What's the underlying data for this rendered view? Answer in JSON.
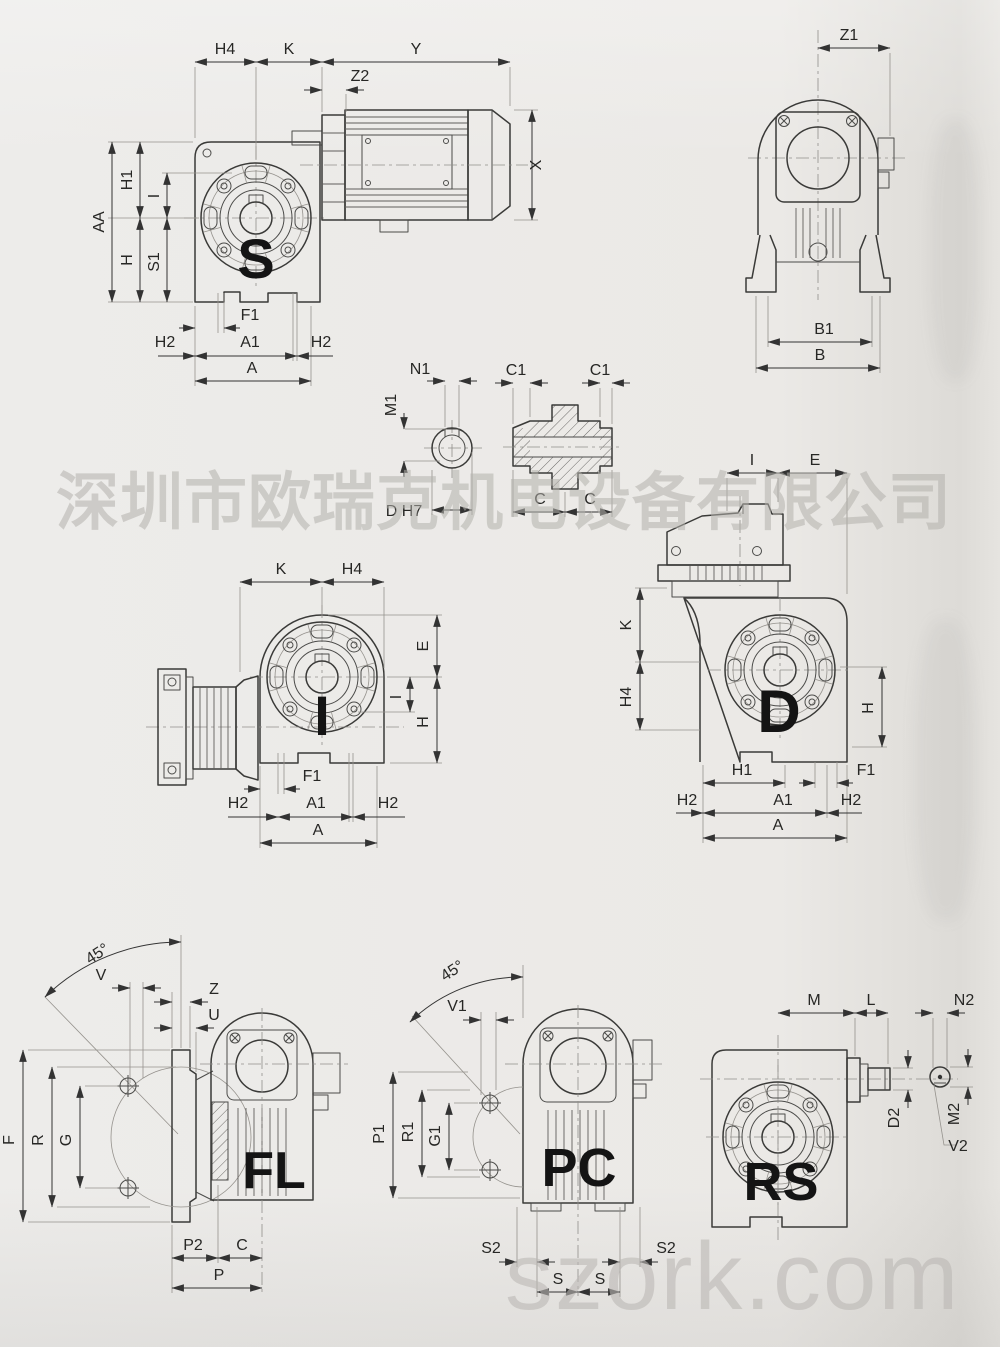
{
  "watermarks": {
    "company": "深圳市欧瑞克机电设备有限公司",
    "site": "szork.com"
  },
  "view_labels": {
    "s": "S",
    "i": "I",
    "d": "D",
    "fl": "FL",
    "pc": "PC",
    "rs": "RS"
  },
  "dims": {
    "H4": "H4",
    "K": "K",
    "Y": "Y",
    "Z2": "Z2",
    "X": "X",
    "AA": "AA",
    "H1": "H1",
    "I": "I",
    "S1": "S1",
    "H": "H",
    "F1": "F1",
    "H2": "H2",
    "A1": "A1",
    "A": "A",
    "Z1": "Z1",
    "B1": "B1",
    "B": "B",
    "N1": "N1",
    "M1": "M1",
    "D_H7": "D H7",
    "C1": "C1",
    "C": "C",
    "E": "E",
    "angle45": "45°",
    "V": "V",
    "Z": "Z",
    "U": "U",
    "F": "F",
    "R": "R",
    "G": "G",
    "P2": "P2",
    "P": "P",
    "V1": "V1",
    "P1": "P1",
    "R1": "R1",
    "G1": "G1",
    "S2": "S2",
    "S": "S",
    "M": "M",
    "L": "L",
    "N2": "N2",
    "D2": "D2",
    "M2": "M2",
    "V2": "V2"
  },
  "colors": {
    "paper": "#ebe9e6",
    "ink": "#3a3a38",
    "dim_line": "#333333",
    "watermark": "#b2b0ac"
  }
}
